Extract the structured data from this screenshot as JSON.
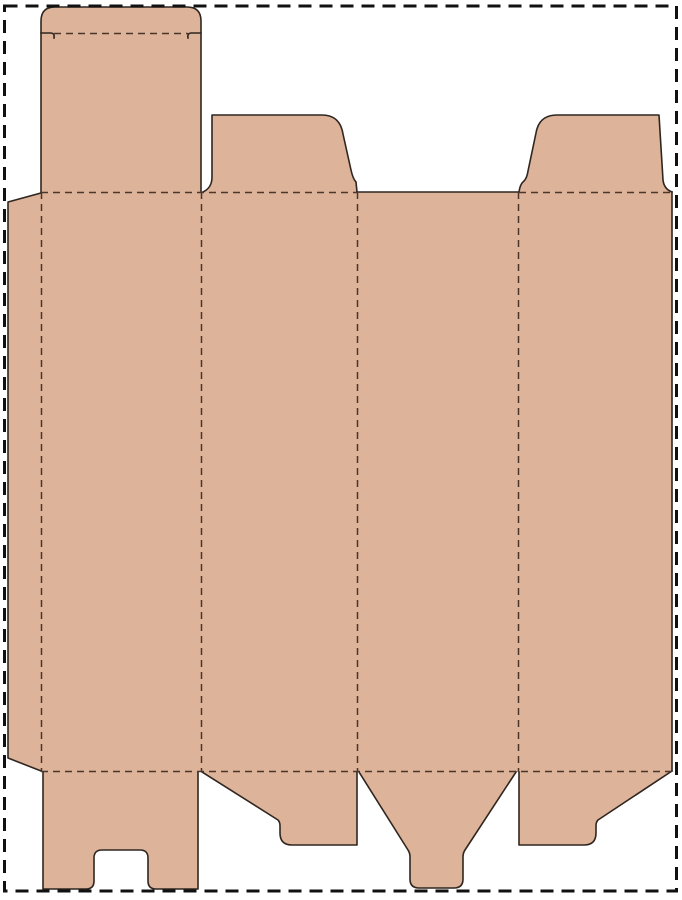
{
  "page": {
    "background": "#ffffff",
    "border": {
      "color": "#111111",
      "thickness": 3,
      "dash": "13 8",
      "x": 4.5,
      "y": 6,
      "width": 672,
      "height": 885
    }
  },
  "dieline": {
    "description": "Flat folding-carton box template (dieline) with four vertical panels, a left glue flap, a top tuck flap with rounded lip, two top dust flaps, a bottom notched tuck tab, two bottom dust flaps and a bottom funnel tab",
    "board_color": "#ddb39a",
    "cut_color": "#2f2620",
    "cut_width": 1.6,
    "fold_color": "#4b362c",
    "fold_width": 1.5,
    "fold_dash": "7 5",
    "outline": "M 8,202 L 41,193 L 41,21 Q 41,7 55,7 L 187,7 Q 201,7 201,21 L 201,192 L 203,192 Q 212,188 212,177 L 212,115 L 322,115 Q 340,115 343,134 L 351,170 Q 353,179 356,182 L 357,192 L 519,192 Q 520,184 524,181 Q 527,178 528,171 L 536,133 Q 539,115 557,115 L 659,115 L 663,180 Q 664,189 672,192 L 672,771 L 598,820 Q 596,822 596,826 L 596,833 Q 596,845 584,845 L 519,845 L 519,772 L 516,772 L 465,850 Q 463,853 463,857 L 463,879 Q 463,888 454,888 L 419,888 Q 410,888 410,879 L 410,857 Q 410,853 408,850 L 359,772 L 357,772 L 357,845 L 292,845 Q 280,845 280,833 L 280,826 Q 280,822 278,820 L 202,772 L 198,772 L 198,889 L 156,889 Q 148,889 148,881 L 148,858 Q 148,850 140,850 L 102,850 Q 94,850 94,858 L 94,881 Q 94,889 86,889 L 43,889 L 43,772 L 41,771 L 8,758 Z",
    "cuts": [
      {
        "name": "glue-flap-cut",
        "d": "M 41,193 L 8,202 L 8,758 L 41,771"
      },
      {
        "name": "tuck-flap-cut",
        "d": "M 41,192 L 41,21 Q 41,7 55,7 L 187,7 Q 201,7 201,21 L 201,192"
      },
      {
        "name": "tuck-lip-hook-left-cut",
        "d": "M 41,33 L 51,33 Q 55,33.5 54,38"
      },
      {
        "name": "tuck-lip-hook-right-cut",
        "d": "M 201,33 L 191,33 Q 187,33.5 188,38"
      },
      {
        "name": "top-dust-flap-left-cut",
        "d": "M 203,192 Q 212,188 212,177 L 212,115 L 322,115 Q 340,115 343,134 L 351,170 Q 353,179 356,182 L 357,192"
      },
      {
        "name": "panel3-top-edge-cut",
        "d": "M 357,192 L 519,192"
      },
      {
        "name": "top-dust-flap-right-cut",
        "d": "M 519,192 Q 520,184 524,181 Q 527,178 528,171 L 536,133 Q 539,115 557,115 L 659,115 L 663,180 Q 664,189 672,192"
      },
      {
        "name": "panel4-right-edge-cut",
        "d": "M 672,192 L 672,771"
      },
      {
        "name": "bottom-dust-flap-right-cut",
        "d": "M 672,771 L 598,820 Q 596,822 596,826 L 596,833 Q 596,845 584,845 L 519,845 L 519,772"
      },
      {
        "name": "bottom-funnel-tab-cut",
        "d": "M 516,772 L 465,850 Q 463,853 463,857 L 463,879 Q 463,888 454,888 L 419,888 Q 410,888 410,879 L 410,857 Q 410,853 408,850 L 359,772"
      },
      {
        "name": "bottom-dust-flap-left-cut",
        "d": "M 357,772 L 357,845 L 292,845 Q 280,845 280,833 L 280,826 Q 280,822 278,820 L 202,772"
      },
      {
        "name": "bottom-notched-tab-cut",
        "d": "M 198,772 L 198,889 L 156,889 Q 148,889 148,881 L 148,858 Q 148,850 140,850 L 102,850 Q 94,850 94,858 L 94,881 Q 94,889 86,889 L 43,889 L 43,772"
      }
    ],
    "folds": [
      {
        "name": "tuck-lip-fold",
        "x1": 54,
        "y1": 33.5,
        "x2": 188,
        "y2": 33.5
      },
      {
        "name": "top-fold-left",
        "x1": 41,
        "y1": 192.5,
        "x2": 357,
        "y2": 192.5
      },
      {
        "name": "top-fold-right",
        "x1": 519,
        "y1": 192.5,
        "x2": 672,
        "y2": 192.5
      },
      {
        "name": "bottom-fold",
        "x1": 41,
        "y1": 771.5,
        "x2": 672,
        "y2": 771.5
      },
      {
        "name": "glue-flap-fold",
        "x1": 41.5,
        "y1": 192,
        "x2": 41.5,
        "y2": 772
      },
      {
        "name": "panel1-panel2-fold",
        "x1": 201.5,
        "y1": 192,
        "x2": 201.5,
        "y2": 772
      },
      {
        "name": "panel2-panel3-fold",
        "x1": 357.5,
        "y1": 192,
        "x2": 357.5,
        "y2": 772
      },
      {
        "name": "panel3-panel4-fold",
        "x1": 518.5,
        "y1": 192,
        "x2": 518.5,
        "y2": 772
      }
    ]
  }
}
